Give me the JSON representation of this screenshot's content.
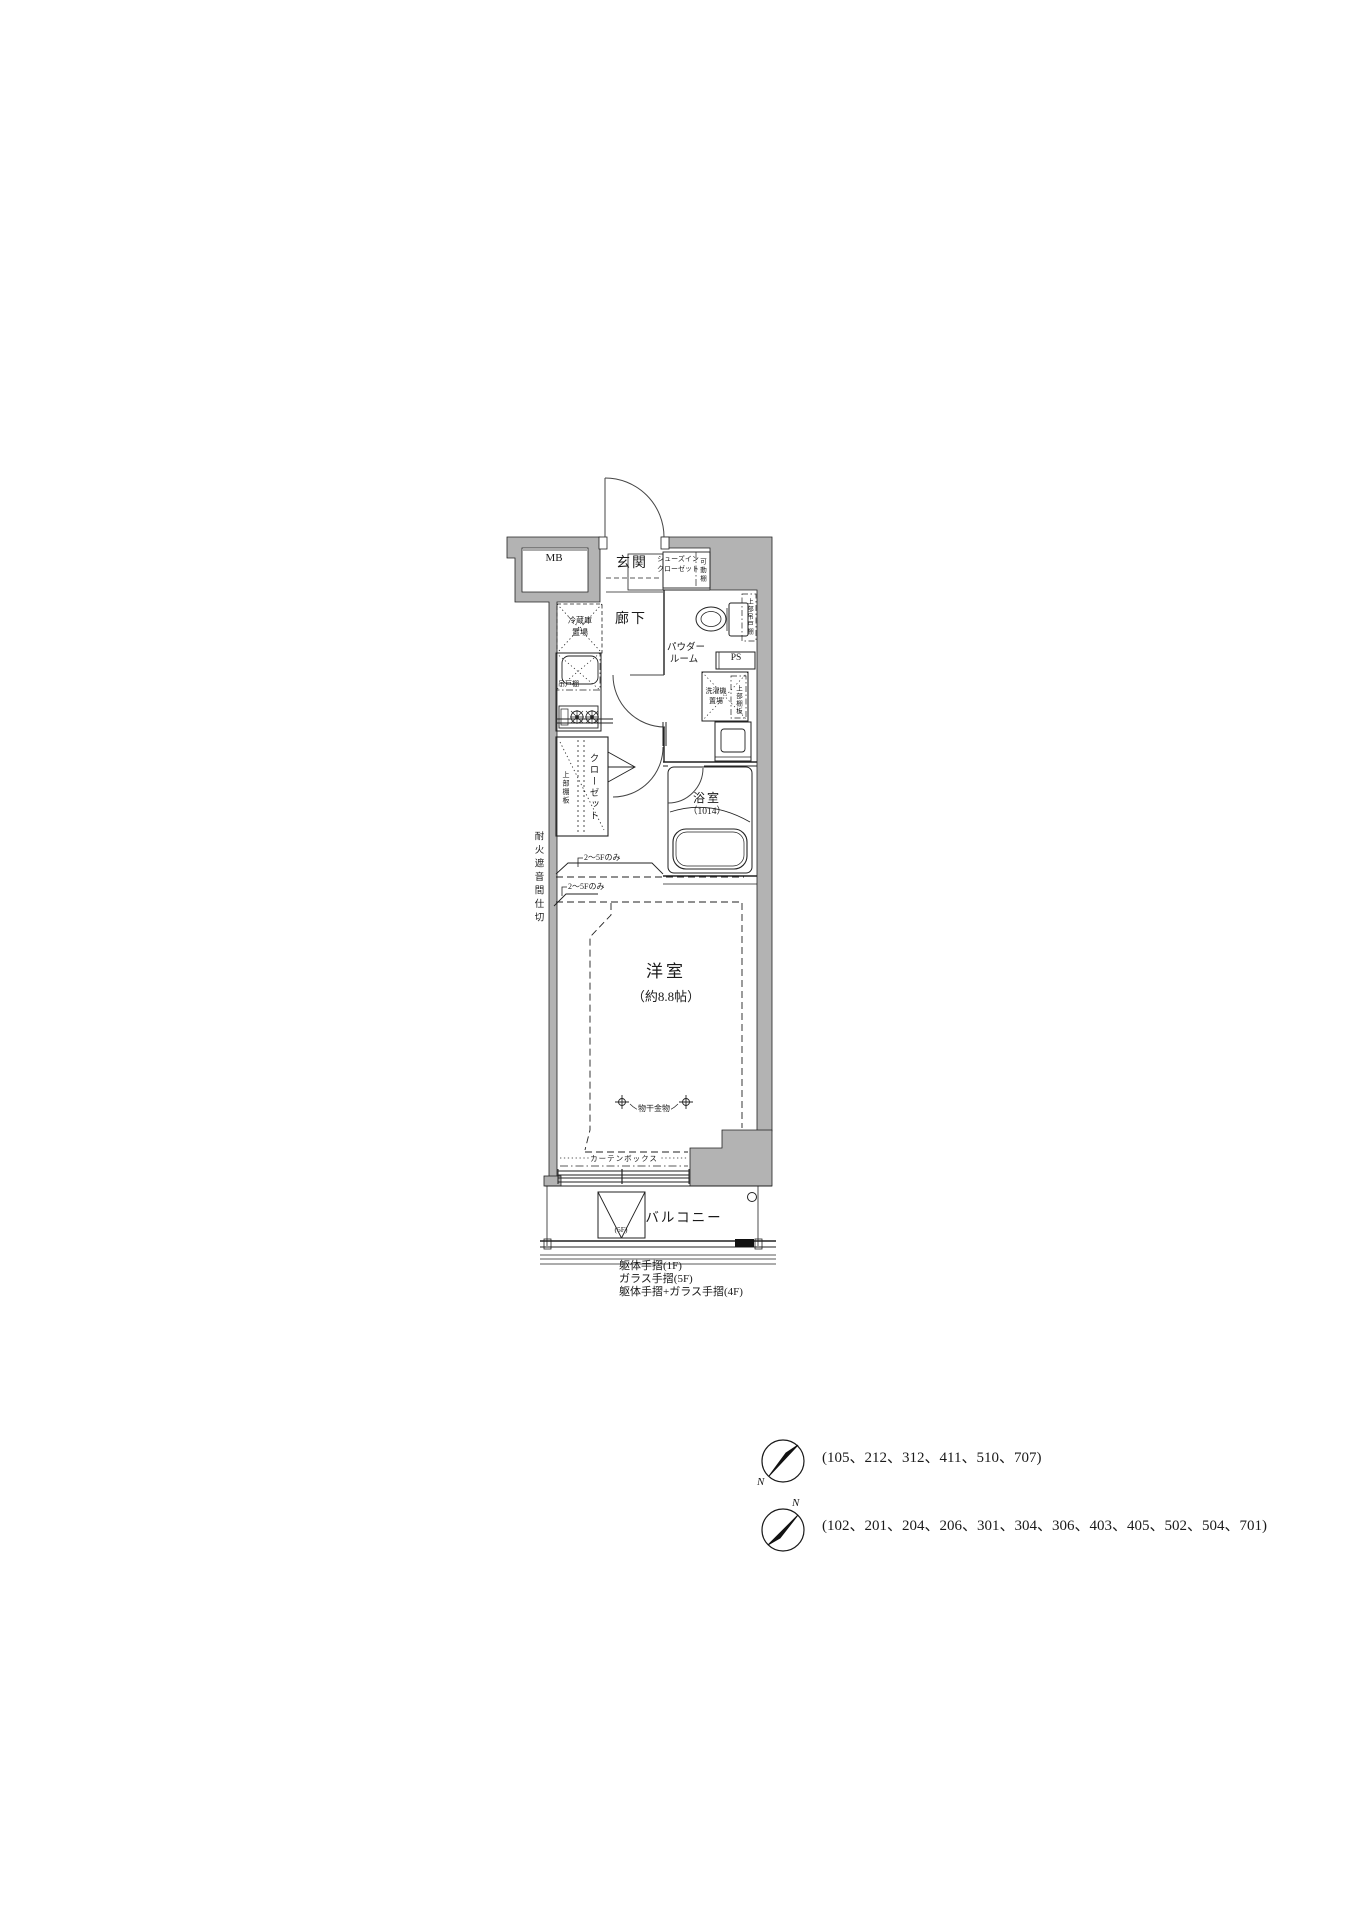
{
  "plan": {
    "labels": {
      "mb": "MB",
      "entrance": "玄関",
      "shoes_closet_line1": "シューズイン",
      "shoes_closet_line2": "クローゼット",
      "movable_shelf": "可動棚",
      "hallway": "廊下",
      "powder_line1": "パウダー",
      "powder_line2": "ルーム",
      "ps": "PS",
      "washer_line1": "洗濯機",
      "washer_line2": "置場",
      "upper_hanging_cabinet": "上部吊戸棚",
      "upper_shelf_powder": "上部棚板",
      "fridge_line1": "冷蔵庫",
      "fridge_line2": "置場",
      "hanging_cupboard": "吊戸棚",
      "closet": "クローゼット",
      "upper_shelf_closet": "上部棚板",
      "bath": "浴室",
      "bath_size": "（1014）",
      "western_room": "洋室",
      "western_room_size": "（約8.8帖）",
      "laundry_hardware": "物干金物",
      "curtain_box": "カーテンボックス",
      "balcony": "バルコニー",
      "balcony_5f": "(5F)",
      "firewall_partition": "耐火遮音間仕切",
      "floors_only_1": "2〜5Fのみ",
      "floors_only_2": "2〜5Fのみ"
    },
    "footnotes": [
      "躯体手摺(1F)",
      "ガラス手摺(5F)",
      "躯体手摺+ガラス手摺(4F)"
    ]
  },
  "compasses": [
    {
      "north_label": "N",
      "units": "(105、212、312、411、510、707)"
    },
    {
      "north_label": "N",
      "units": "(102、201、204、206、301、304、306、403、405、502、504、701)"
    }
  ],
  "colors": {
    "wall_fill": "#b3b3b3",
    "line": "#1a1a1a",
    "background": "#ffffff"
  }
}
